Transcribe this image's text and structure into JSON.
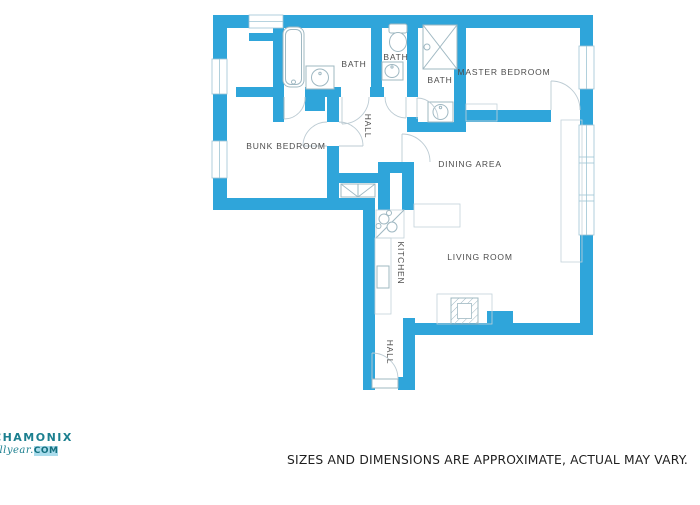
{
  "colors": {
    "wall": "#2FA5DA",
    "fixture_outline": "#9FB8C2",
    "door_swing": "#BCCBD3",
    "room_label": "#4d4d4d",
    "footer_text": "#1f1f1f",
    "logo_teal": "#1b7f8f",
    "logo_highlight": "#aadcec",
    "background": "#ffffff"
  },
  "floorplan": {
    "rooms": [
      {
        "id": "bath-1",
        "label": "BATH"
      },
      {
        "id": "bath-2",
        "label": "BATH"
      },
      {
        "id": "bath-3",
        "label": "BATH"
      },
      {
        "id": "master-bedroom",
        "label": "MASTER BEDROOM"
      },
      {
        "id": "bunk-bedroom",
        "label": "BUNK BEDROOM"
      },
      {
        "id": "hall-upper",
        "label": "HALL"
      },
      {
        "id": "dining-area",
        "label": "DINING AREA"
      },
      {
        "id": "kitchen",
        "label": "KITCHEN"
      },
      {
        "id": "living-room",
        "label": "LIVING ROOM"
      },
      {
        "id": "hall-lower",
        "label": "HALL"
      }
    ],
    "fixtures": [
      "bathtub",
      "sink",
      "toilet",
      "shower",
      "stove",
      "kitchen-sink",
      "fireplace",
      "closet",
      "window"
    ]
  },
  "footer": {
    "disclaimer": "SIZES AND DIMENSIONS ARE APPROXIMATE, ACTUAL MAY VARY."
  },
  "logo": {
    "line1": "CHAMONIX",
    "line2_name": "allyear.",
    "line2_tld": "COM"
  }
}
